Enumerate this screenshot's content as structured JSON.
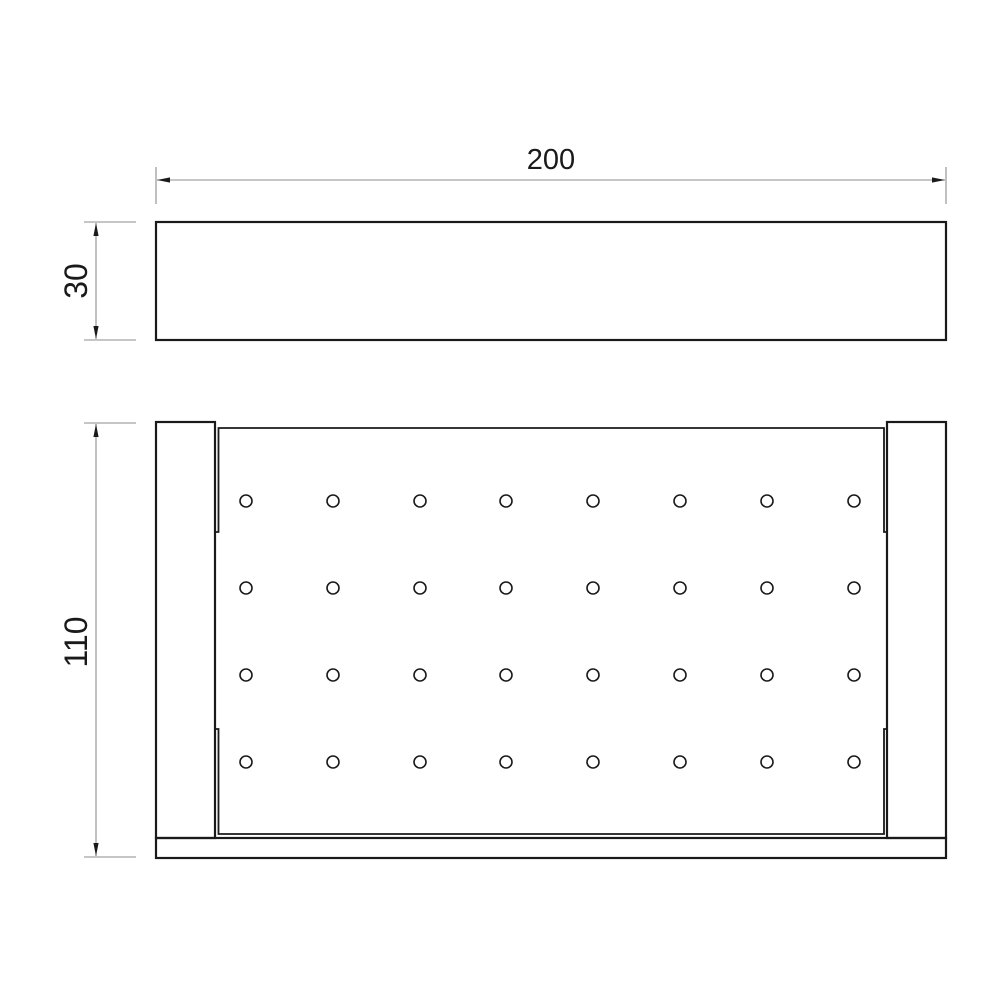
{
  "canvas": {
    "width": 1000,
    "height": 1000,
    "background": "#ffffff"
  },
  "style": {
    "object_color": "#1a1a1a",
    "object_stroke": 2.2,
    "plate_stroke": 1.8,
    "hole_stroke": 1.6,
    "dim_color": "#8c8c8c",
    "dim_stroke": 1.1,
    "text_color": "#1a1a1a",
    "arrow_length": 13,
    "arrow_half_width": 2.6
  },
  "front_view": {
    "description": "front elevation of shelf, plain rectangle",
    "rect": {
      "x": 156,
      "y": 222,
      "w": 790,
      "h": 118
    }
  },
  "plan_view": {
    "description": "plan view of perforated shelf with side brackets and bottom rail",
    "left_bracket": {
      "x": 156,
      "y": 422,
      "w": 59,
      "h": 416
    },
    "right_bracket": {
      "x": 887,
      "y": 422,
      "w": 59,
      "h": 416
    },
    "bottom_rail": {
      "x": 156,
      "y": 838,
      "w": 790,
      "h": 20
    },
    "plate": {
      "left": 218.5,
      "right": 884,
      "top": 428,
      "bottom": 834,
      "tick_left": 214.5,
      "tick_right": 888,
      "break_top": 532,
      "break_bottom": 729
    },
    "holes": {
      "cols": [
        246,
        333,
        420,
        506,
        593,
        680,
        767,
        854
      ],
      "rows": [
        501,
        588,
        675,
        762
      ],
      "radius": 6,
      "count": 32
    }
  },
  "dimensions": [
    {
      "id": "width-200",
      "label": "200",
      "value": 200,
      "orientation": "horizontal",
      "line": [
        157,
        180,
        945,
        180
      ],
      "extensions": [
        [
          156,
          167,
          156,
          204
        ],
        [
          946,
          167,
          946,
          204
        ]
      ],
      "arrows": [
        [
          157,
          180,
          "left"
        ],
        [
          945,
          180,
          "right"
        ]
      ],
      "text": {
        "x": 551,
        "y": 169,
        "rotate": 0,
        "size": 29
      }
    },
    {
      "id": "front-height-30",
      "label": "30",
      "value": 30,
      "orientation": "vertical",
      "line": [
        96,
        223,
        96,
        339
      ],
      "extensions": [
        [
          84,
          222,
          136,
          222
        ],
        [
          84,
          340,
          136,
          340
        ]
      ],
      "arrows": [
        [
          96,
          223,
          "up"
        ],
        [
          96,
          339,
          "down"
        ]
      ],
      "text": {
        "x": 87,
        "y": 281,
        "rotate": -90,
        "size": 32
      }
    },
    {
      "id": "plan-height-110",
      "label": "110",
      "value": 110,
      "orientation": "vertical",
      "line": [
        96,
        424,
        96,
        856
      ],
      "extensions": [
        [
          84,
          423,
          136,
          423
        ],
        [
          84,
          857,
          136,
          857
        ]
      ],
      "arrows": [
        [
          96,
          424,
          "up"
        ],
        [
          96,
          856,
          "down"
        ]
      ],
      "text": {
        "x": 87,
        "y": 642,
        "rotate": -90,
        "size": 32
      }
    }
  ]
}
